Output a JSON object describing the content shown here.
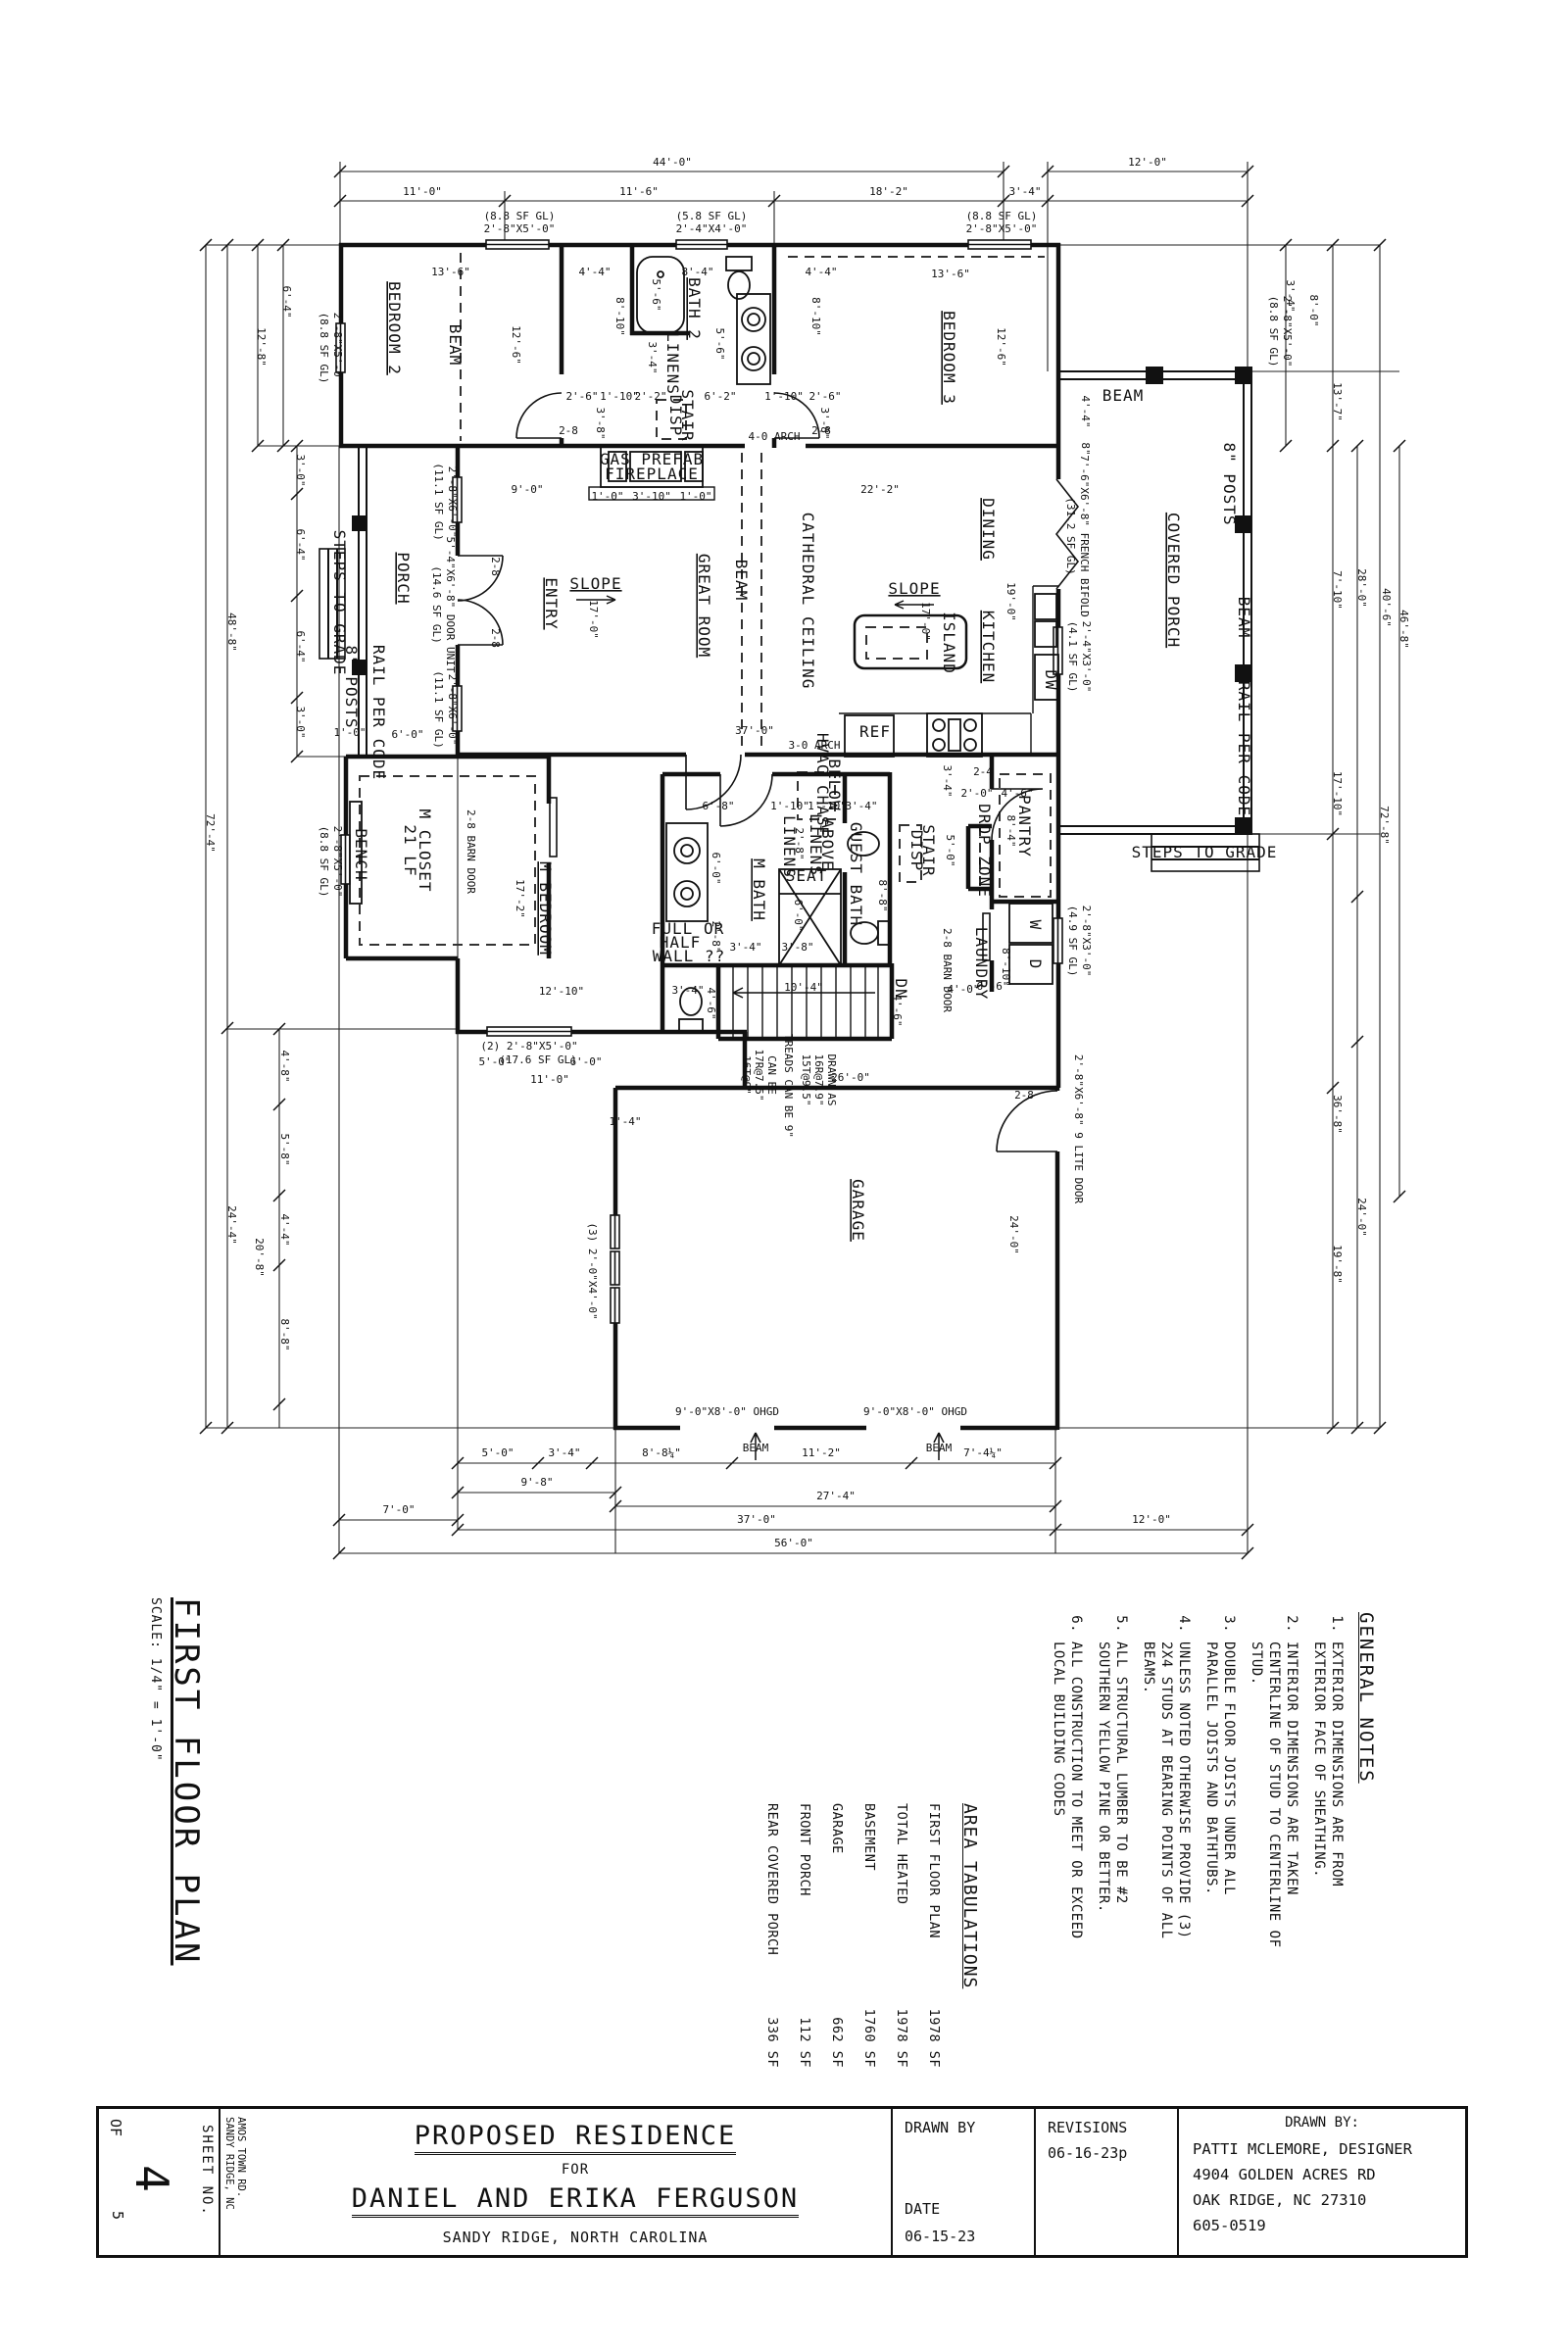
{
  "sheet_title": {
    "name": "FIRST FLOOR PLAN",
    "scale": "SCALE: 1/4\" = 1'-0\""
  },
  "general_notes": {
    "heading": "GENERAL NOTES",
    "items": [
      "EXTERIOR DIMENSIONS ARE FROM EXTERIOR FACE OF SHEATHING.",
      "INTERIOR DIMENSIONS ARE TAKEN CENTERLINE OF STUD TO CENTERLINE OF STUD.",
      "DOUBLE FLOOR JOISTS UNDER ALL PARALLEL JOISTS AND BATHTUBS.",
      "UNLESS NOTED OTHERWISE PROVIDE (3) 2X4 STUDS AT BEARING POINTS OF ALL BEAMS.",
      "ALL STRUCTURAL LUMBER TO BE #2 SOUTHERN YELLOW PINE OR BETTER.",
      "ALL CONSTRUCTION TO MEET OR EXCEED LOCAL BUILDING CODES"
    ]
  },
  "area_tabulations": {
    "heading": "AREA TABULATIONS",
    "rows": [
      [
        "FIRST FLOOR PLAN",
        "1978 SF"
      ],
      [
        "TOTAL HEATED",
        "1978 SF"
      ],
      [
        "BASEMENT",
        "1760 SF"
      ],
      [
        "GARAGE",
        "662 SF"
      ],
      [
        "FRONT PORCH",
        "112 SF"
      ],
      [
        "REAR COVERED PORCH",
        "336 SF"
      ]
    ]
  },
  "title_block": {
    "sheet_no_label": "SHEET NO.",
    "sheet_no": "4",
    "of_label": "OF",
    "of_total": "5",
    "address_lines": "AMOS TOWN RD.\nSANDY RIDGE, NC",
    "project_title": "PROPOSED RESIDENCE",
    "for_label": "FOR",
    "client": "DANIEL AND ERIKA FERGUSON",
    "location": "SANDY RIDGE, NORTH CAROLINA",
    "drawn_by_label": "DRAWN BY",
    "date_label": "DATE",
    "date": "06-15-23",
    "revisions_label": "REVISIONS",
    "revision": "06-16-23p",
    "designer_heading": "DRAWN BY:",
    "designer_lines": [
      "PATTI MCLEMORE, DESIGNER",
      "4904 GOLDEN ACRES RD",
      "OAK RIDGE, NC  27310",
      "605-0519"
    ]
  },
  "plan": {
    "labels": [
      [
        "BEDROOM 2",
        397,
        335,
        1,
        16,
        1
      ],
      [
        "BATH 2",
        703,
        315,
        1,
        16,
        1
      ],
      [
        "BEDROOM 3",
        963,
        365,
        1,
        16,
        1
      ],
      [
        "DINING",
        1003,
        540,
        1,
        16,
        1
      ],
      [
        "KITCHEN",
        1003,
        660,
        1,
        16,
        1
      ],
      [
        "GREAT ROOM",
        713,
        618,
        1,
        16,
        1
      ],
      [
        "ENTRY",
        557,
        616,
        1,
        16,
        1
      ],
      [
        "PORCH",
        406,
        590,
        1,
        16,
        1
      ],
      [
        "COVERED PORCH",
        1192,
        592,
        1,
        16,
        1
      ],
      [
        "M BEDROOM",
        551,
        927,
        1,
        16,
        1
      ],
      [
        "M BATH",
        769,
        908,
        1,
        16,
        1
      ],
      [
        "GUEST BATH",
        868,
        892,
        1,
        13,
        0
      ],
      [
        "M CLOSET",
        428,
        868,
        1,
        13,
        0
      ],
      [
        "21 LF",
        413,
        868,
        1,
        13,
        0
      ],
      [
        "LAUNDRY",
        996,
        983,
        1,
        13,
        0
      ],
      [
        "PANTRY",
        1040,
        843,
        1,
        13,
        0
      ],
      [
        "GARAGE",
        870,
        1235,
        1,
        16,
        1
      ],
      [
        "DISP",
        684,
        424,
        1,
        11,
        0
      ],
      [
        "STAIR",
        696,
        424,
        1,
        11,
        0
      ],
      [
        "DISP",
        930,
        868,
        1,
        11,
        0
      ],
      [
        "STAIR",
        942,
        868,
        1,
        11,
        0
      ],
      [
        "DROP ZONE",
        999,
        868,
        1,
        11,
        0
      ],
      [
        "LINENS",
        681,
        371,
        1,
        11,
        0
      ],
      [
        "LINENS",
        800,
        864,
        1,
        11,
        0
      ],
      [
        "LINENS",
        827,
        862,
        1,
        11,
        0
      ],
      [
        "ABOVE",
        839,
        862,
        1,
        11,
        0
      ],
      [
        "SEAT",
        823,
        899,
        0,
        11,
        0
      ],
      [
        "BENCH",
        363,
        872,
        1,
        11,
        0
      ],
      [
        "ISLAND",
        963,
        656,
        1,
        12,
        0
      ],
      [
        "BEAM",
        459,
        352,
        1,
        11,
        0
      ],
      [
        "BEAM",
        751,
        592,
        1,
        11,
        0
      ],
      [
        "CATHEDRAL CEILING",
        819,
        613,
        1,
        12,
        0
      ],
      [
        "BEAM",
        1146,
        409,
        0,
        12,
        0
      ],
      [
        "BEAM",
        1264,
        630,
        1,
        11,
        0
      ],
      [
        "8\" POSTS",
        1249,
        494,
        1,
        11,
        0
      ],
      [
        "8\" POSTS",
        353,
        701,
        1,
        11,
        0
      ],
      [
        "RAIL PER CODE",
        381,
        727,
        1,
        11,
        0
      ],
      [
        "RAIL PER CODE",
        1264,
        764,
        1,
        11,
        0
      ],
      [
        "STEPS TO GRADE",
        341,
        615,
        1,
        11,
        0
      ],
      [
        "STEPS TO GRADE",
        1229,
        875,
        0,
        12,
        0
      ],
      [
        "GAS PREFAB",
        665,
        474,
        0,
        12,
        0
      ],
      [
        "FIREPLACE",
        665,
        489,
        0,
        12,
        0
      ],
      [
        "SLOPE",
        608,
        601,
        0,
        12,
        1
      ],
      [
        "SLOPE",
        933,
        606,
        0,
        12,
        1
      ],
      [
        "REF",
        893,
        752,
        0,
        12,
        0
      ],
      [
        "DW",
        1067,
        694,
        1,
        11,
        0
      ],
      [
        "W",
        1051,
        944,
        1,
        11,
        0
      ],
      [
        "D",
        1051,
        984,
        1,
        11,
        0
      ],
      [
        "DN",
        914,
        1009,
        1,
        11,
        0
      ],
      [
        "HVAC CHASE",
        834,
        801,
        1,
        10,
        0
      ],
      [
        "BELOW",
        846,
        801,
        1,
        10,
        0
      ],
      [
        "FULL OR",
        702,
        953,
        0,
        11,
        0
      ],
      [
        "HALF",
        694,
        967,
        0,
        11,
        0
      ],
      [
        "WALL ??",
        703,
        981,
        0,
        11,
        0
      ]
    ],
    "dims": [
      [
        "44'-0\"",
        686,
        169,
        0
      ],
      [
        "12'-0\"",
        1171,
        169,
        0
      ],
      [
        "11'-0\"",
        431,
        199,
        0
      ],
      [
        "11'-6\"",
        652,
        199,
        0
      ],
      [
        "18'-2\"",
        907,
        199,
        0
      ],
      [
        "3'-4\"",
        1046,
        199,
        0
      ],
      [
        "(8.8 SF GL)",
        530,
        224,
        0
      ],
      [
        "2'-8\"X5'-0\"",
        530,
        237,
        0
      ],
      [
        "(5.8 SF GL)",
        726,
        224,
        0
      ],
      [
        "2'-4\"X4'-0\"",
        726,
        237,
        0
      ],
      [
        "(8.8 SF GL)",
        1022,
        224,
        0
      ],
      [
        "2'-8\"X5'-0\"",
        1022,
        237,
        0
      ],
      [
        "(8.8 SF GL)",
        1296,
        338,
        1
      ],
      [
        "2'-8\"X5'-0\"",
        1310,
        338,
        1
      ],
      [
        "13'-6\"",
        460,
        281,
        0
      ],
      [
        "4'-4\"",
        607,
        281,
        0
      ],
      [
        "8'-4\"",
        712,
        281,
        0
      ],
      [
        "4'-4\"",
        838,
        281,
        0
      ],
      [
        "13'-6\"",
        970,
        283,
        0
      ],
      [
        "12'-6\"",
        523,
        352,
        1
      ],
      [
        "12'-6\"",
        1018,
        354,
        1
      ],
      [
        "8'-10\"",
        629,
        323,
        1
      ],
      [
        "8'-10\"",
        829,
        323,
        1
      ],
      [
        "5'-6\"",
        666,
        301,
        1
      ],
      [
        "5'-6\"",
        731,
        351,
        1
      ],
      [
        "3'-4\"",
        662,
        365,
        1
      ],
      [
        "2'-6\"",
        594,
        408,
        0
      ],
      [
        "1'-10\"",
        632,
        408,
        0
      ],
      [
        "2'-2\"",
        664,
        408,
        0
      ],
      [
        "6'-2\"",
        735,
        408,
        0
      ],
      [
        "1'-10\"",
        800,
        408,
        0
      ],
      [
        "2'-6\"",
        842,
        408,
        0
      ],
      [
        "3'-8\"",
        609,
        432,
        1
      ],
      [
        "3'-8\"",
        838,
        432,
        1
      ],
      [
        "9'-0\"",
        538,
        503,
        0
      ],
      [
        "22'-2\"",
        898,
        503,
        0
      ],
      [
        "19'-0\"",
        1028,
        614,
        1
      ],
      [
        "17'-0\"",
        602,
        632,
        1
      ],
      [
        "17'-0\"",
        941,
        634,
        1
      ],
      [
        "4-0 ARCH",
        790,
        449,
        0
      ],
      [
        "3-0 ARCH",
        831,
        764,
        0
      ],
      [
        "37'-0\"",
        770,
        749,
        0
      ],
      [
        "2-8",
        580,
        443,
        0
      ],
      [
        "2-8",
        838,
        443,
        0
      ],
      [
        "2-8",
        502,
        578,
        1
      ],
      [
        "2-8",
        502,
        651,
        1
      ],
      [
        "1'-0\"",
        620,
        510,
        0
      ],
      [
        "3'-10\"",
        665,
        510,
        0
      ],
      [
        "1'-0\"",
        710,
        510,
        0
      ],
      [
        "1'-0\"",
        357,
        751,
        0
      ],
      [
        "6'-0\"",
        416,
        753,
        0
      ],
      [
        "4'-4\"",
        1104,
        420,
        1
      ],
      [
        "8\"",
        1104,
        458,
        1
      ],
      [
        "6'-8\"",
        733,
        826,
        0
      ],
      [
        "1'-10\"",
        806,
        826,
        0
      ],
      [
        "1'-10\"",
        844,
        826,
        0
      ],
      [
        "3'-4\"",
        879,
        826,
        0
      ],
      [
        "2'-8\"",
        812,
        861,
        1
      ],
      [
        "6'-0\"",
        727,
        886,
        1
      ],
      [
        "6'-0\"",
        811,
        934,
        1
      ],
      [
        "2'-8\"",
        727,
        956,
        1
      ],
      [
        "3'-4\"",
        761,
        970,
        0
      ],
      [
        "3'-8\"",
        814,
        970,
        0
      ],
      [
        "8'-8\"",
        897,
        914,
        1
      ],
      [
        "3'-4\"",
        702,
        1014,
        0
      ],
      [
        "4'-6\"",
        722,
        1024,
        1
      ],
      [
        "10'-4\"",
        820,
        1011,
        0
      ],
      [
        "4'-0\"",
        983,
        1013,
        0
      ],
      [
        "4'-6\"",
        912,
        1031,
        1
      ],
      [
        "3'-4\"",
        963,
        797,
        1
      ],
      [
        "5'-0\"",
        966,
        868,
        1
      ],
      [
        "2'-0\"",
        997,
        813,
        0
      ],
      [
        "4'-6\"",
        1038,
        813,
        0
      ],
      [
        "2-4",
        1003,
        791,
        0
      ],
      [
        "8'-4\"",
        1028,
        848,
        1
      ],
      [
        "8'-10\"",
        1023,
        987,
        1
      ],
      [
        "6'-6\"",
        1013,
        1010,
        0
      ],
      [
        "2-8 BARN DOOR",
        477,
        869,
        1
      ],
      [
        "2-8 BARN DOOR",
        963,
        990,
        1
      ],
      [
        "17'-2\"",
        527,
        917,
        1
      ],
      [
        "12'-10\"",
        573,
        1015,
        0
      ],
      [
        "(8.8 SF GL)",
        327,
        355,
        1
      ],
      [
        "2'-8\"X5'-0\"",
        341,
        355,
        1
      ],
      [
        "(8.8 SF GL)",
        327,
        879,
        1
      ],
      [
        "2'-8\"X5'-0\"",
        341,
        879,
        1
      ],
      [
        "(14.6 SF GL)",
        442,
        617,
        1
      ],
      [
        "5'-4\"X6'-8\" DOOR UNIT",
        456,
        617,
        1
      ],
      [
        "(11.1 SF GL)",
        444,
        512,
        1
      ],
      [
        "2'-8\"X6'-0\"",
        458,
        512,
        1
      ],
      [
        "(11.1 SF GL)",
        444,
        724,
        1
      ],
      [
        "2'-8\"X6'-0\"",
        458,
        724,
        1
      ],
      [
        "(31.2 SF GL)",
        1089,
        547,
        1
      ],
      [
        "7'-6\"X6'-8\" FRENCH BIFOLD",
        1103,
        547,
        1
      ],
      [
        "(4.1 SF GL)",
        1091,
        670,
        1
      ],
      [
        "2'-4\"X3'-0\"",
        1105,
        670,
        1
      ],
      [
        "(4.9 SF GL)",
        1091,
        960,
        1
      ],
      [
        "2'-8\"X3'-0\"",
        1105,
        960,
        1
      ],
      [
        "(3) 2'-0\"X4'-0\"",
        601,
        1297,
        1
      ],
      [
        "2'-8\"X6'-8\" 9 LITE DOOR",
        1097,
        1152,
        1
      ],
      [
        "2-8",
        1045,
        1121,
        0
      ],
      [
        "(2) 2'-8\"X5'-0\"",
        540,
        1071,
        0
      ],
      [
        "5'-0\"",
        505,
        1087,
        0
      ],
      [
        "(17.6 SF GL)",
        549,
        1085,
        0
      ],
      [
        "6'-0\"",
        598,
        1087,
        0
      ],
      [
        "11'-0\"",
        561,
        1105,
        0
      ],
      [
        "DRAWN AS",
        845,
        1102,
        1
      ],
      [
        "16R@7.9\"",
        832,
        1102,
        1
      ],
      [
        "15T@9.5\"",
        819,
        1102,
        1
      ],
      [
        "TREADS CAN BE 9\"",
        801,
        1108,
        1
      ],
      [
        "CAN BE",
        784,
        1097,
        1
      ],
      [
        "17R@7.5\"",
        771,
        1097,
        1
      ],
      [
        "16T@9\"",
        758,
        1097,
        1
      ],
      [
        "26'-0\"",
        868,
        1103,
        0
      ],
      [
        "24'-0\"",
        1031,
        1260,
        1
      ],
      [
        "1'-4\"",
        638,
        1148,
        0
      ],
      [
        "9'-0\"X8'-0\" OHGD",
        742,
        1444,
        0
      ],
      [
        "9'-0\"X8'-0\" OHGD",
        934,
        1444,
        0
      ],
      [
        "BEAM",
        771,
        1481,
        0
      ],
      [
        "BEAM",
        958,
        1481,
        0
      ],
      [
        "5'-0\"",
        508,
        1486,
        0
      ],
      [
        "3'-4\"",
        576,
        1486,
        0
      ],
      [
        "8'-8¼\"",
        675,
        1486,
        0
      ],
      [
        "11'-2\"",
        838,
        1486,
        0
      ],
      [
        "7'-4¼\"",
        1003,
        1486,
        0
      ],
      [
        "9'-8\"",
        548,
        1516,
        0
      ],
      [
        "7'-0\"",
        407,
        1544,
        0
      ],
      [
        "27'-4\"",
        853,
        1530,
        0
      ],
      [
        "37'-0\"",
        772,
        1554,
        0
      ],
      [
        "12'-0\"",
        1175,
        1554,
        0
      ],
      [
        "56'-0\"",
        810,
        1578,
        0
      ],
      [
        "6'-4\"",
        289,
        308,
        1
      ],
      [
        "12'-8\"",
        263,
        354,
        1
      ],
      [
        "3'-0\"",
        303,
        480,
        1
      ],
      [
        "6'-4\"",
        303,
        556,
        1
      ],
      [
        "6'-4\"",
        303,
        660,
        1
      ],
      [
        "3'-0\"",
        303,
        737,
        1
      ],
      [
        "48'-8\"",
        233,
        645,
        1
      ],
      [
        "72'-4\"",
        211,
        850,
        1
      ],
      [
        "24'-4\"",
        233,
        1250,
        1
      ],
      [
        "20'-8\"",
        261,
        1283,
        1
      ],
      [
        "4'-8\"",
        287,
        1088,
        1
      ],
      [
        "5'-8\"",
        287,
        1173,
        1
      ],
      [
        "4'-4\"",
        287,
        1255,
        1
      ],
      [
        "8'-8\"",
        287,
        1362,
        1
      ],
      [
        "3'-4\"",
        1313,
        302,
        1
      ],
      [
        "8'-0\"",
        1337,
        317,
        1
      ],
      [
        "13'-7\"",
        1361,
        410,
        1
      ],
      [
        "7'-10\"",
        1361,
        602,
        1
      ],
      [
        "28'-0\"",
        1386,
        600,
        1
      ],
      [
        "40'-6\"",
        1411,
        620,
        1
      ],
      [
        "46'-8\"",
        1429,
        642,
        1
      ],
      [
        "17'-10\"",
        1361,
        810,
        1
      ],
      [
        "72'-8\"",
        1409,
        842,
        1
      ],
      [
        "36'-8\"",
        1361,
        1137,
        1
      ],
      [
        "24'-0\"",
        1386,
        1242,
        1
      ],
      [
        "19'-8\"",
        1361,
        1290,
        1
      ]
    ]
  }
}
